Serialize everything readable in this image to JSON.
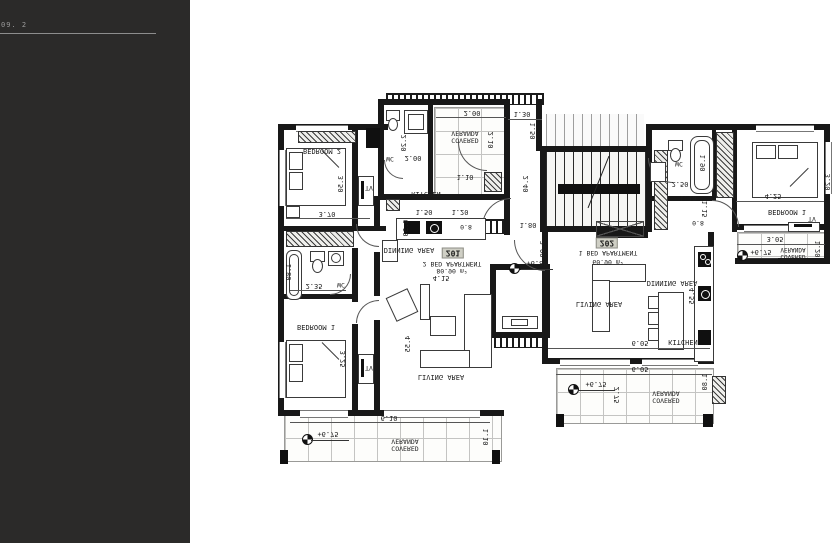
{
  "sidebar": {
    "note": "09. 2"
  },
  "apartments": [
    {
      "number": "201",
      "type": "2 BED APARTMENT",
      "area": "80.90 m²",
      "entry_width": "4.15"
    },
    {
      "number": "202",
      "type": "1 BED APARTMENT",
      "area": "60.90 m²"
    }
  ],
  "levels": {
    "entry": "+6.80",
    "veranda": "+6.75"
  },
  "rooms": {
    "bedroom2": "BEDROOM 2",
    "bedroom1": "BEDROOM 1",
    "kitchen": "KITCHEN",
    "dinning": "DINNING AREA",
    "living": "LIVING AREA",
    "wc": "WC",
    "tv": "TV",
    "covered_veranda": "COVERED VERANDA"
  },
  "dims": {
    "bed2_w": "3.70",
    "bed2_h": "3.50",
    "wc_top_h": "2.20",
    "wc_top_w": "2.00",
    "ver_top_w": "2.00",
    "ver_top_h": "2.10",
    "corr_w": "1.30",
    "corr_h1": "1.50",
    "corr_h2": "2.40",
    "kit_pass": "1.10",
    "kit_w1": "1.50",
    "kit_w2": "1.20",
    "kit_d": "0.50",
    "entry_w": "1.80",
    "entry_h": "2.00",
    "door": "0.8",
    "bath_w": "2.35",
    "bath_tub": "1.80",
    "bed1_h": "3.25",
    "living_h": "4.55",
    "ver_bl_w": "6.10",
    "ver_bl_h": "1.10",
    "wc_r_w": "2.50",
    "wc_r_tub": "1.90",
    "corr_r_w": "1.10",
    "corr_r_h": "1.15",
    "bed1r_w": "4.25",
    "bed1r_h": "3.20",
    "ver_r_w": "3.05",
    "ver_r_h": "1.20",
    "kit_r_h": "4.55",
    "apt2_w": "6.05",
    "ver_br_w": "6.05",
    "ver_br_h": "2.75",
    "ver_br_side": "1.80"
  }
}
